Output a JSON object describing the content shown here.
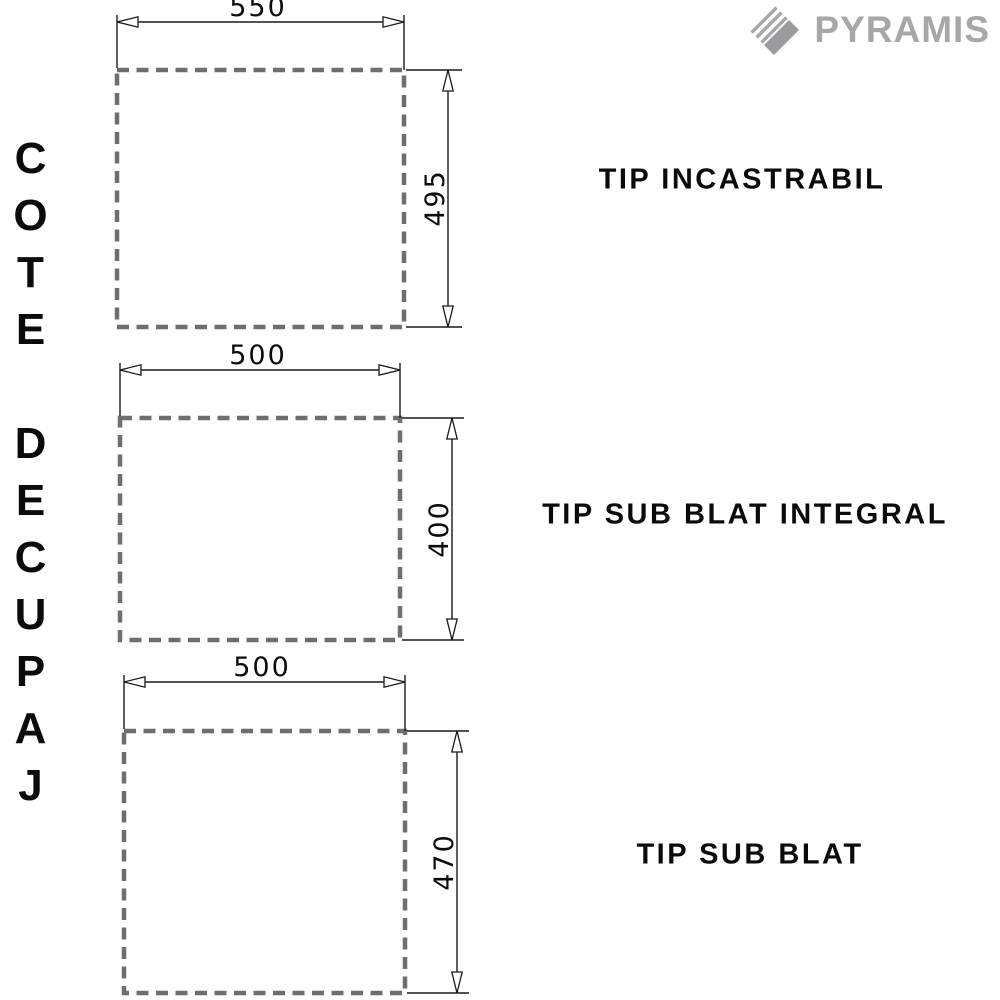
{
  "logo": {
    "brand": "PYRAMIS"
  },
  "sidebar": {
    "vertical_text": "COTE DECUPAJ"
  },
  "figures": [
    {
      "label": "TIP INCASTRABIL",
      "width_label": "550",
      "height_label": "495"
    },
    {
      "label": "TIP SUB BLAT INTEGRAL",
      "width_label": "500",
      "height_label": "400"
    },
    {
      "label": "TIP SUB BLAT",
      "width_label": "500",
      "height_label": "470"
    }
  ],
  "colors": {
    "dashed_outline": "#6e6e6e",
    "dimension_line": "#1a1a1a",
    "text": "#0b0b0b",
    "logo_gray": "#a7a7aa",
    "background": "#ffffff"
  }
}
